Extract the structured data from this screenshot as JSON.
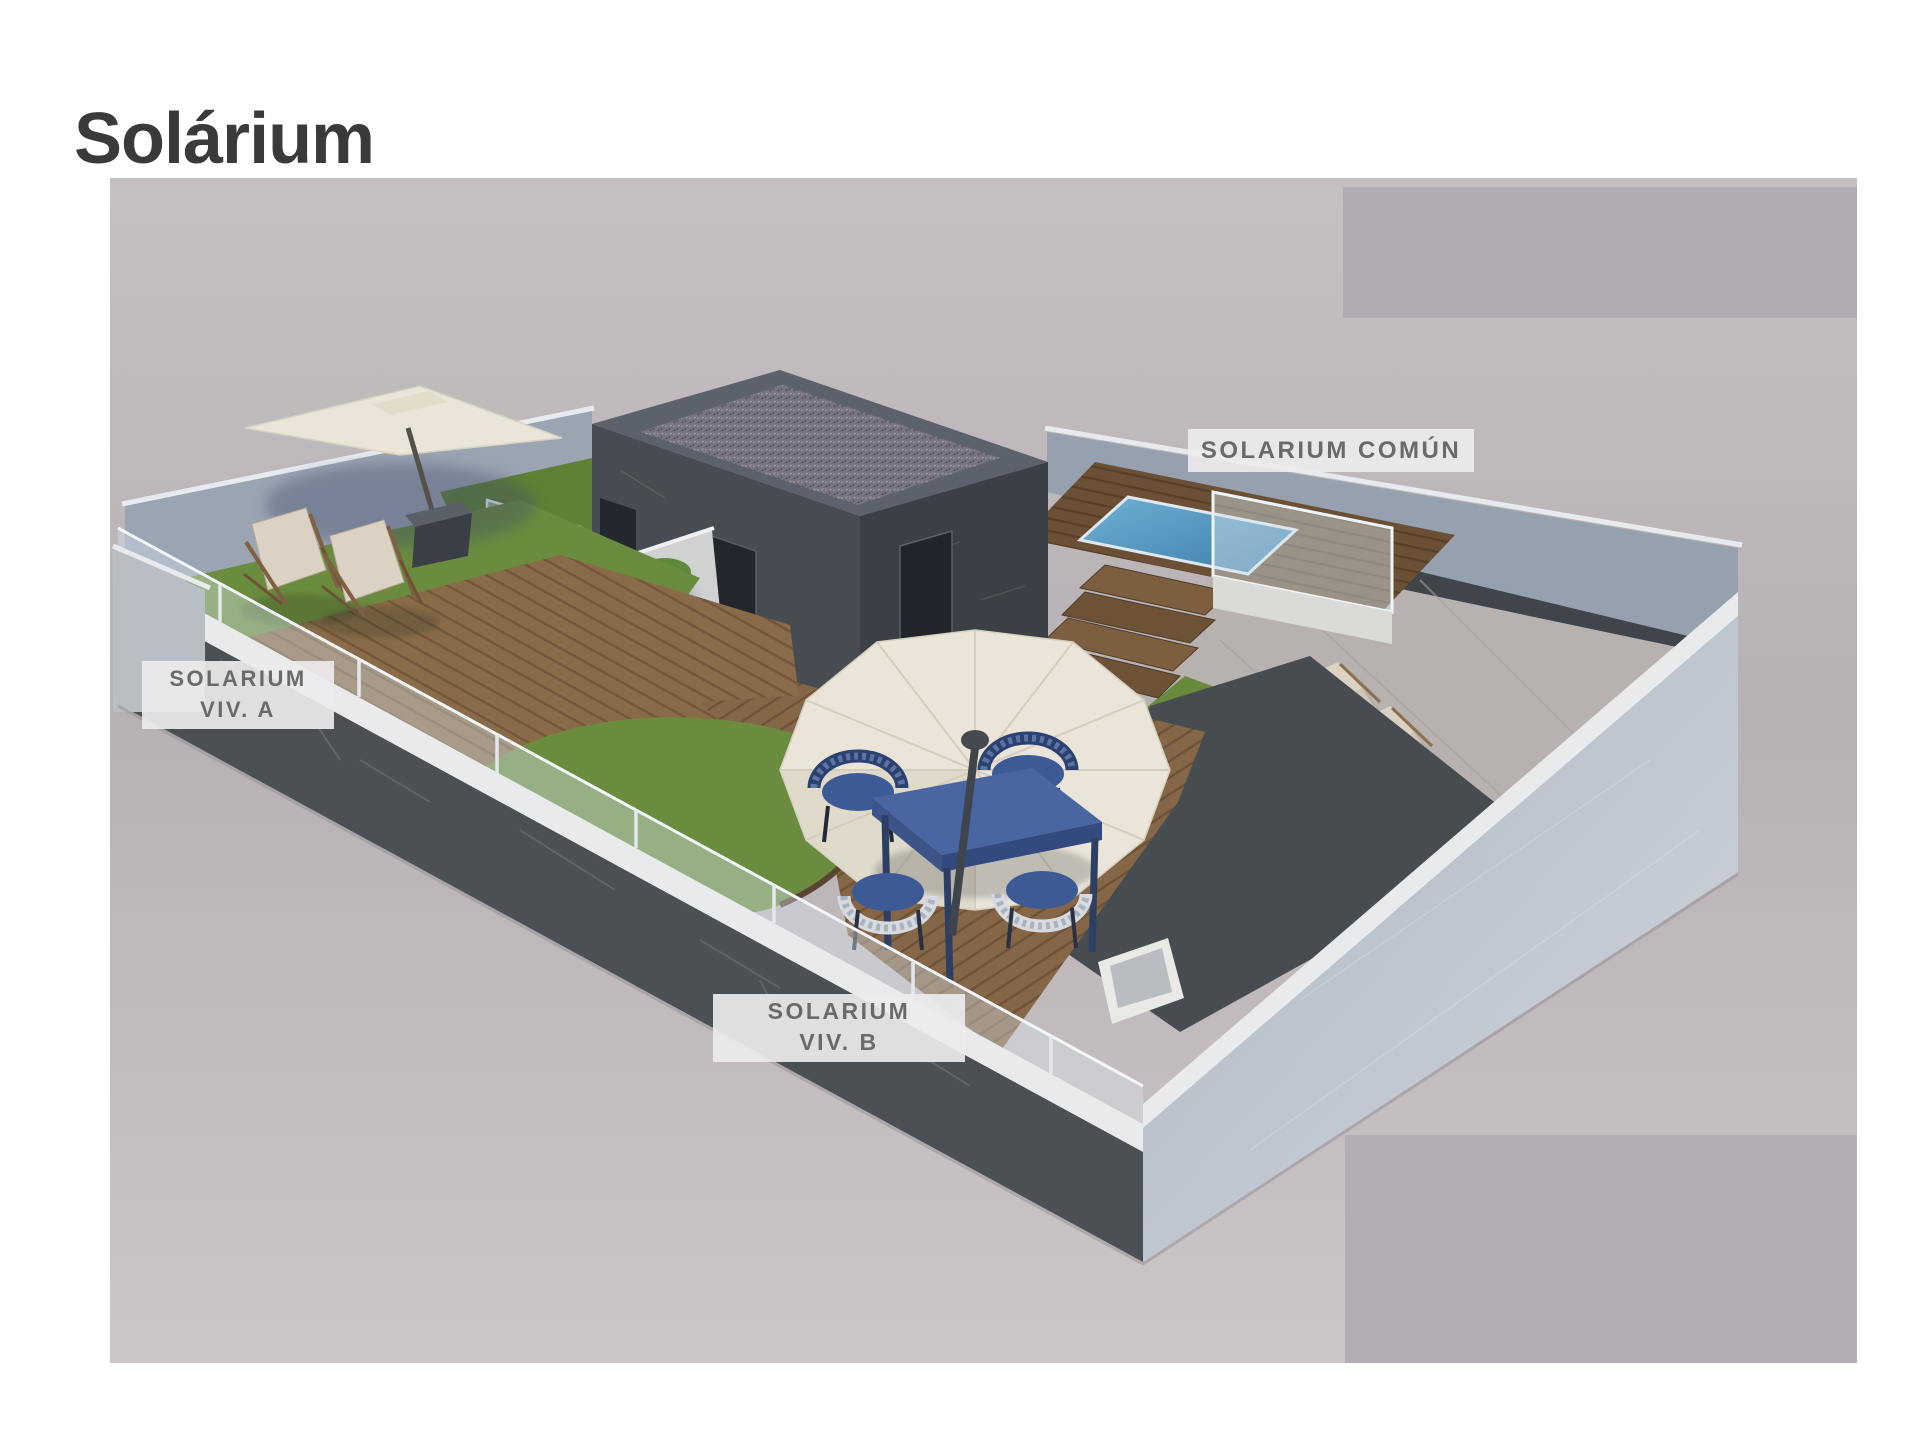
{
  "page": {
    "title": "Solárium"
  },
  "labels": {
    "common": {
      "text": "SOLARIUM COMÚN"
    },
    "viv_a": {
      "lines": [
        "SOLARIUM",
        "VIV. A"
      ]
    },
    "viv_b": {
      "lines": [
        "SOLARIUM",
        "VIV. B"
      ]
    }
  },
  "colors": {
    "page_bg": "#ffffff",
    "title_text": "#3a3a3c",
    "label_text": "#6a6a6e",
    "label_bg": "rgba(236,234,237,0.92)",
    "scene_top": "#c6c0c2",
    "scene_mid": "#b7b1b5",
    "scene_bottom": "#ccc6c7",
    "overlay_gray": "#b1abb4",
    "back_wall": "#9ba4b2",
    "dark_marble_wall": "#4b5054",
    "white_coping": "#e9eaec",
    "glass": "rgba(214,228,236,0.40)",
    "deck_wood": "#8a6b49",
    "pool_deck_wood": "#6b5036",
    "grass": "#6b8c3f",
    "pool_water_light": "#6fb0d6",
    "pool_water_deep": "#3c7ca8",
    "roof_gravel": "#777381",
    "roof_parapet": "#5b626b",
    "building_left_face": "#474c52",
    "building_right_face": "#3a4046",
    "door": "#23282e",
    "door_knob": "#d9b23a",
    "divider_wall": "#cfd2d0",
    "foliage": "#4e7a33",
    "flower": "#b5413a",
    "umbrella_canvas": "#eae5d8",
    "table_blue": "#4a66a2",
    "chair_navy": "#2b4170",
    "chair_white": "#d7dbe0",
    "chair_cushion": "#3c5a96",
    "lounger_cream": "#dbd2c4",
    "stone_floor": "#b7b2b0",
    "trough_white": "#e9e9e5"
  }
}
